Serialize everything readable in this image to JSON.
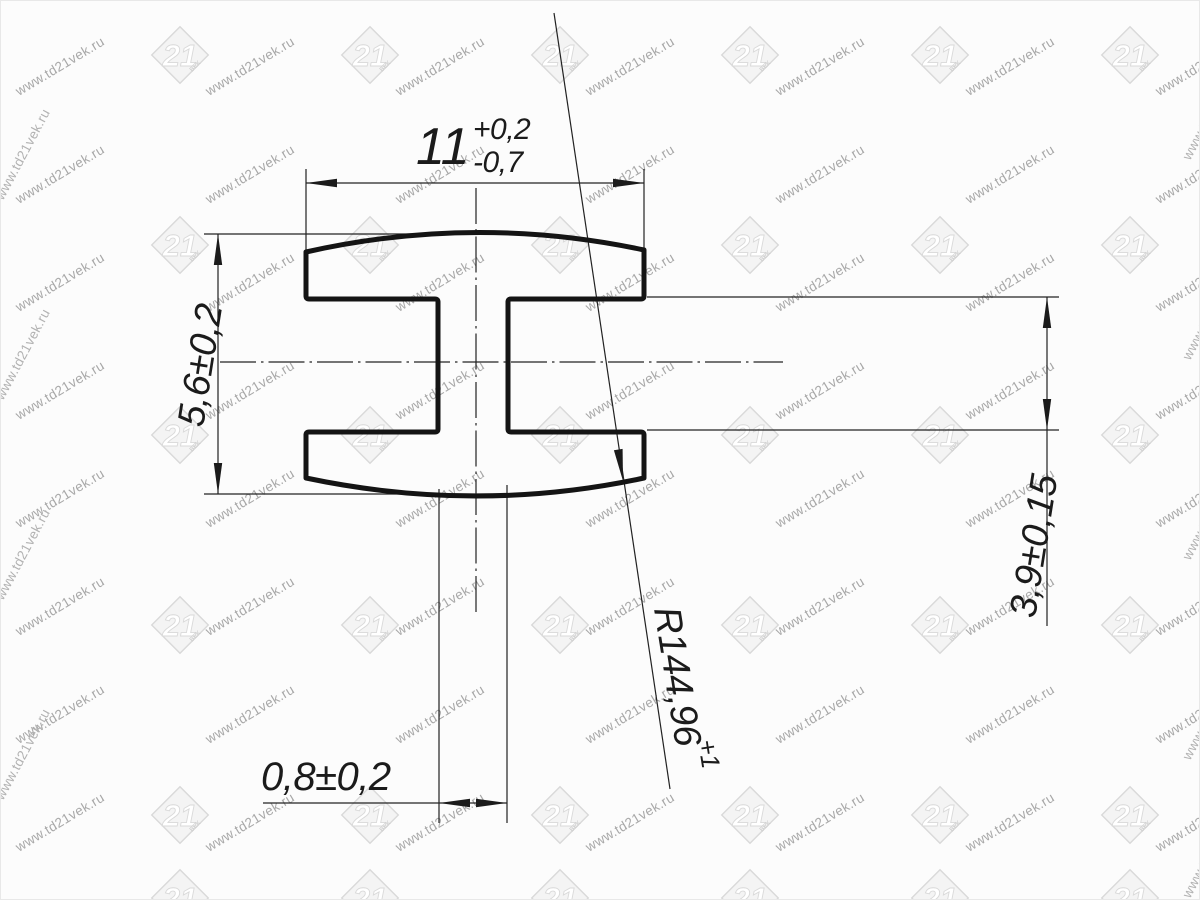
{
  "canvas": {
    "width": 1200,
    "height": 900,
    "background": "#fcfcfc"
  },
  "colors": {
    "outline": "#141414",
    "thin_lines": "#222222",
    "watermark_text": "#a8a8a8",
    "watermark_logo": "#d9d9d9"
  },
  "watermark": {
    "url_text": "www.td21vek.ru",
    "logo_number": "21",
    "logo_caption": "ВЕК"
  },
  "dimensions": {
    "top_width": {
      "value": "11",
      "tol_upper": "+0,2",
      "tol_lower": "-0,7"
    },
    "left_height": {
      "value": "5,6±0,2"
    },
    "right_gap": {
      "value": "3,9±0,15"
    },
    "bottom_wall": {
      "value": "0,8±0,2"
    },
    "radius": {
      "value": "R144,96",
      "tol": "+1"
    }
  }
}
